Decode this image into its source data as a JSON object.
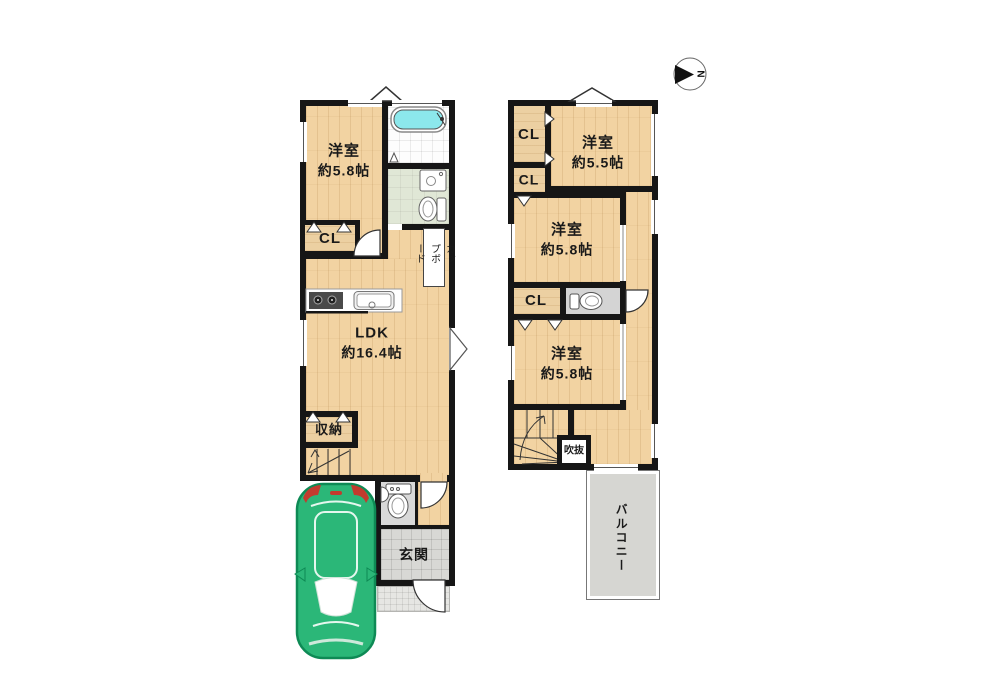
{
  "compass": {
    "north_label": "N"
  },
  "floor1": {
    "western_room": {
      "name": "洋室",
      "size": "約5.8帖"
    },
    "closet": "CL",
    "cupboard": "カップボード",
    "ldk": {
      "name": "LDK",
      "size": "約16.4帖"
    },
    "storage": "収納",
    "entrance": "玄関"
  },
  "floor2": {
    "closet1": "CL",
    "closet2": "CL",
    "closet3": "CL",
    "western_room_55": {
      "name": "洋室",
      "size": "約5.5帖"
    },
    "western_room_58a": {
      "name": "洋室",
      "size": "約5.8帖"
    },
    "western_room_58b": {
      "name": "洋室",
      "size": "約5.8帖"
    },
    "void": "吹抜",
    "balcony": "バルコニー"
  },
  "colors": {
    "wall": "#161616",
    "wood_floor": "#f2d3a2",
    "bathtub": "#8ce8ec",
    "car_body": "#2bb778",
    "balcony_floor": "#d6d6d2"
  }
}
